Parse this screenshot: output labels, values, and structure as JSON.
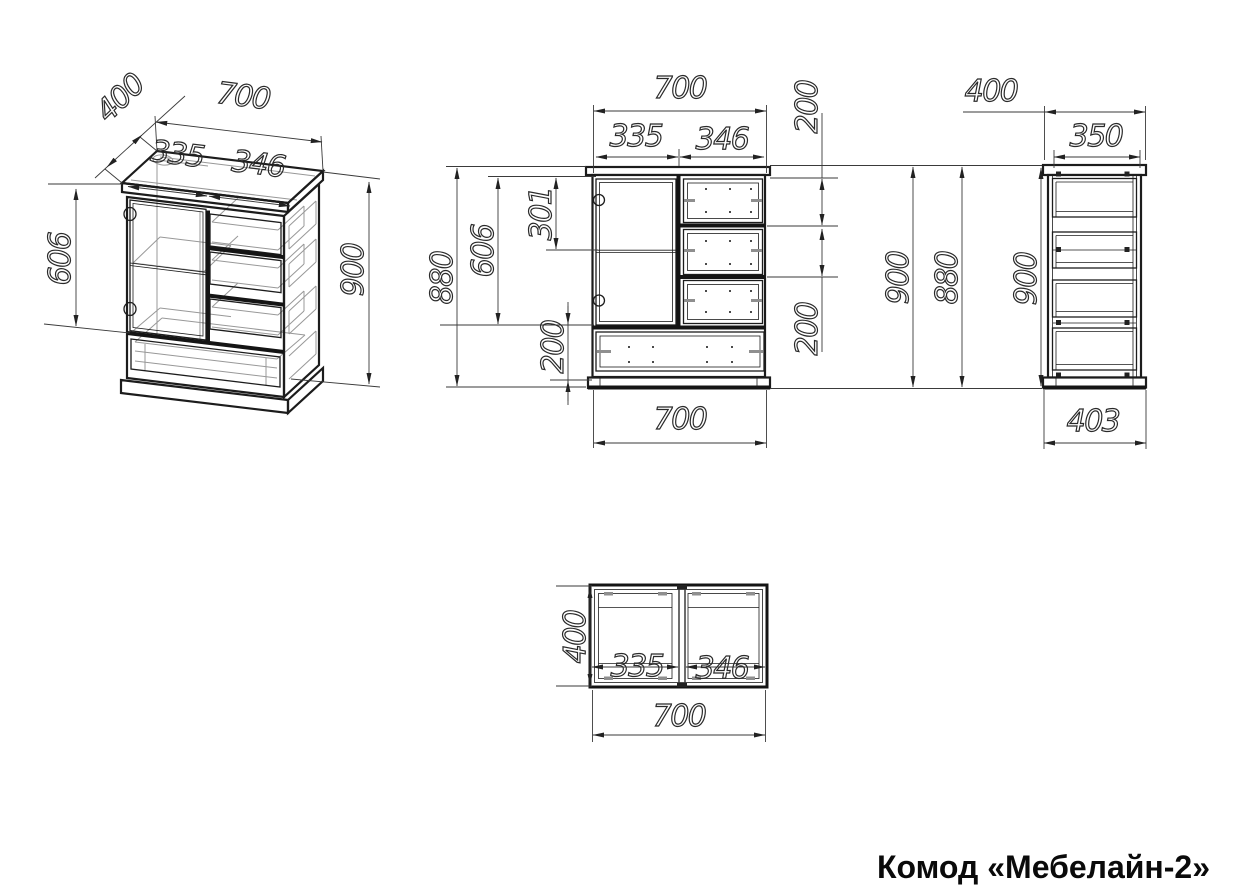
{
  "title": "Комод «Мебелайн-2»",
  "colors": {
    "background": "#ffffff",
    "main_line": "#1c1c1c",
    "dim_line": "#3a3a3a",
    "wireframe_gray": "#989898",
    "title_text": "#0a0a0a"
  },
  "views": {
    "isometric": {
      "label": "isometric projection",
      "dims": {
        "depth": "400",
        "width": "700",
        "door_width": "335",
        "drawer_width": "346",
        "door_height": "606",
        "height": "900"
      }
    },
    "front": {
      "label": "front view",
      "dims": {
        "width": "700",
        "door_width": "335",
        "drawer_width": "346",
        "drawer_height_1": "200",
        "drawer_height_2": "200",
        "body_height": "880",
        "door_height": "606",
        "door_upper_section": "301",
        "bottom_drawer_height": "200",
        "total_height": "900",
        "width_bottom": "700"
      }
    },
    "side": {
      "label": "side view",
      "dims": {
        "depth": "400",
        "inner_depth": "350",
        "body_height": "880",
        "total_height": "900",
        "base_depth": "403"
      }
    },
    "top": {
      "label": "top view",
      "dims": {
        "depth": "400",
        "door_width": "335",
        "drawer_width": "346",
        "width": "700"
      }
    }
  }
}
